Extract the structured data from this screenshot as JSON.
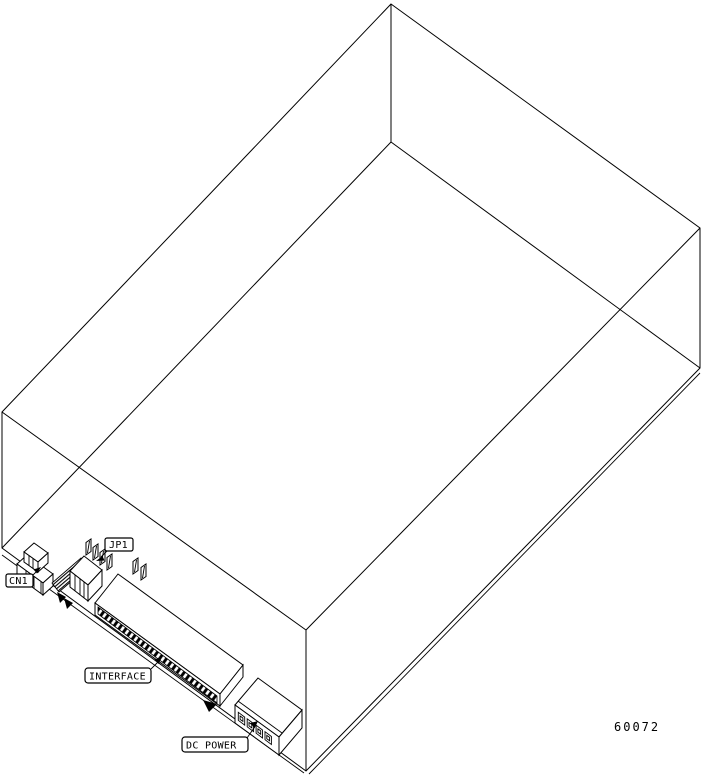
{
  "figure": {
    "number": "60072",
    "ink_color": "#000000",
    "paper_color": "#ffffff"
  },
  "labels": {
    "cn1": "CN1",
    "jp1": "JP1",
    "interface": "INTERFACE",
    "dc_power": "DC POWER"
  }
}
